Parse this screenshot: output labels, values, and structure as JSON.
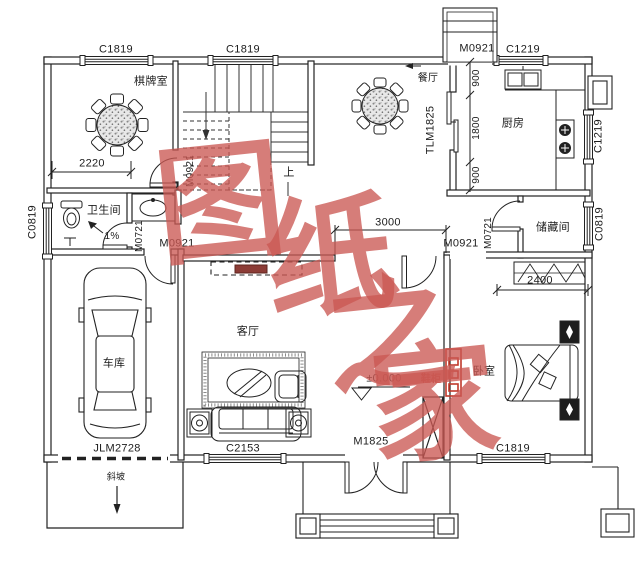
{
  "windows": {
    "c1819": "C1819",
    "c1219": "C1219",
    "c0819": "C0819",
    "c2153": "C2153"
  },
  "doors": {
    "m0921": "M0921",
    "m0721": "M0721",
    "m1825": "M1825",
    "tlm1825": "TLM1825",
    "jlm2728": "JLM2728"
  },
  "rooms": {
    "chess": "棋牌室",
    "dining": "餐厅",
    "kitchen": "厨房",
    "bath": "卫生间",
    "storage": "储藏间",
    "garage": "车库",
    "living": "客厅",
    "bedroom": "卧室"
  },
  "dims": {
    "w2220": "2220",
    "w3000": "3000",
    "w2400": "2400",
    "h900": "900",
    "h1800": "1800"
  },
  "notes": {
    "up": "上",
    "slope": "斜坡",
    "grade": "1%",
    "level": "±0.000",
    "shoe": "鞋柜"
  },
  "watermark": {
    "c1": "图",
    "c2": "纸",
    "c3": "之",
    "c4": "家"
  },
  "colors": {
    "line": "#222222",
    "accent_red": "#c0392b",
    "watermark": "#cb5953"
  }
}
